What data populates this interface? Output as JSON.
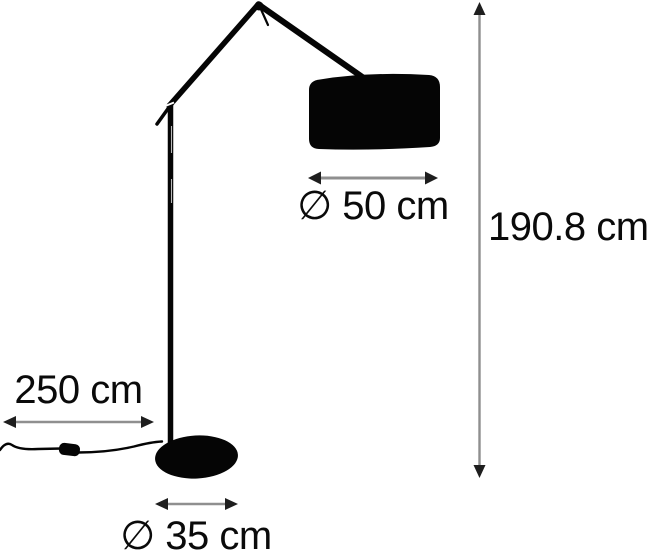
{
  "labels": {
    "shade_diameter": "∅ 50 cm",
    "height": "190.8 cm",
    "cord_length": "250 cm",
    "base_diameter": "∅ 35 cm"
  },
  "colors": {
    "bg": "#ffffff",
    "silhouette": "#050505",
    "dim-line": "#8f8f8f",
    "dim-arrow": "#1e1e1e",
    "text": "#0a0a0a"
  }
}
